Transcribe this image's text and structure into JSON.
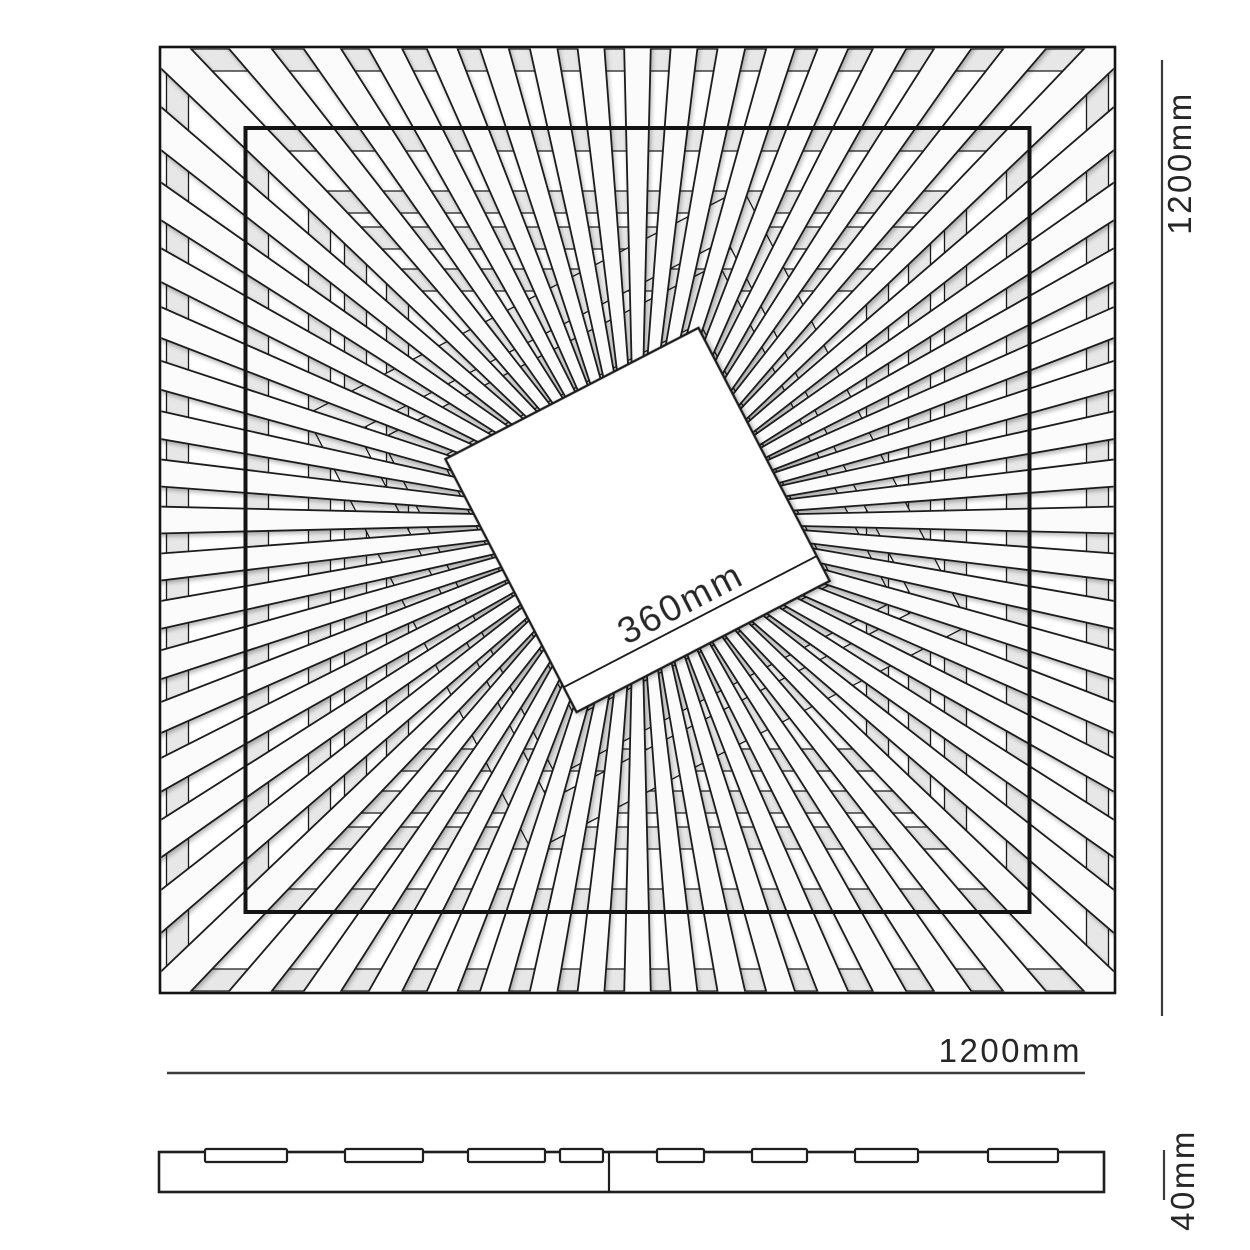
{
  "title": "Square sunburst slat panel dimension drawing",
  "labels": {
    "panel_height": "1200mm",
    "panel_width": "1200mm",
    "center_square": "360mm",
    "thickness": "40mm"
  },
  "figure": {
    "line_color": "#1b1b1b",
    "dim_line_color": "#3c3c3c",
    "plank_fill": "#fbfbfb",
    "band_fill": "#e7e7e7",
    "band_fill_light": "#efefef",
    "slat_count": 64,
    "center_square_rotation_deg": -27.4,
    "views": [
      "top view",
      "side profile"
    ],
    "side_profile_tab_count": 8,
    "side_profile_tabs": [
      {
        "x": 205,
        "w": 82
      },
      {
        "x": 345,
        "w": 78
      },
      {
        "x": 468,
        "w": 77
      },
      {
        "x": 560,
        "w": 43
      },
      {
        "x": 657,
        "w": 47
      },
      {
        "x": 752,
        "w": 55
      },
      {
        "x": 855,
        "w": 63
      },
      {
        "x": 988,
        "w": 70
      }
    ],
    "axis_band_halves": [
      [
        449,
        471
      ],
      [
        369,
        391
      ],
      [
        307,
        329
      ],
      [
        271,
        293
      ],
      [
        229,
        251
      ]
    ],
    "rotated_band_halves": [
      [
        146,
        190
      ],
      [
        208,
        246
      ]
    ]
  }
}
